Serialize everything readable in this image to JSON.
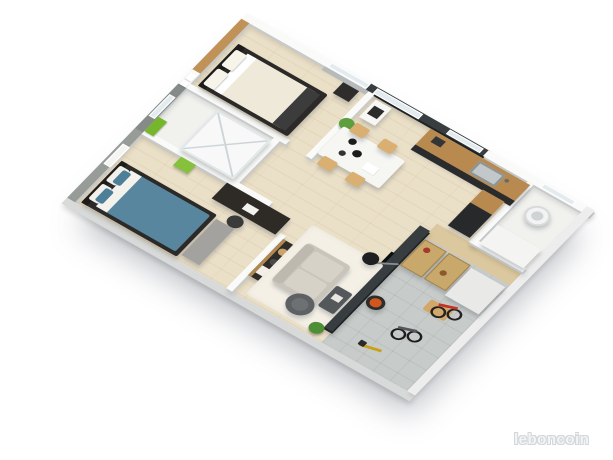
{
  "watermark": {
    "text": "leboncoin",
    "color": "#d3d7da"
  },
  "scene": {
    "type": "3d-isometric-floor-plan",
    "rooms": [
      {
        "name": "bedroom-1",
        "furniture": [
          "double-bed-cream",
          "dark-headboard",
          "dark-throw",
          "nightstand",
          "grey-curtains",
          "wood-accent-wall",
          "wall-frames"
        ]
      },
      {
        "name": "entry",
        "furniture": [
          "hanging-plant",
          "entry-console"
        ]
      },
      {
        "name": "bathroom",
        "furniture": [
          "walk-in-shower",
          "green-towel",
          "window"
        ]
      },
      {
        "name": "bedroom-2",
        "furniture": [
          "double-bed-blue",
          "desk",
          "office-chair",
          "grey-bench",
          "green-cabinet",
          "wall-frame"
        ]
      },
      {
        "name": "living-room",
        "furniture": [
          "light-grey-sofa",
          "white-rug",
          "coffee-table",
          "arc-floor-lamp",
          "dark-armchair",
          "floor-plant",
          "tv-divider-wall",
          "sideboard"
        ]
      },
      {
        "name": "dining-area",
        "furniture": [
          "white-dining-table",
          "wooden-chair",
          "wooden-chair",
          "wooden-chair",
          "wooden-chair",
          "black-tableware"
        ]
      },
      {
        "name": "kitchen",
        "furniture": [
          "l-shaped-counter",
          "steel-sink",
          "dark-cabinets",
          "window",
          "french-doors"
        ]
      },
      {
        "name": "laundry-wc",
        "furniture": [
          "washing-machine",
          "white-cabinet",
          "window"
        ]
      },
      {
        "name": "terrace",
        "furniture": [
          "wood-decking",
          "wooden-shelf-unit",
          "wooden-shelf-unit",
          "storage-cabinet",
          "barbecue",
          "doormat",
          "exercise-bike-red",
          "exercise-bike-black",
          "rowing-machine"
        ]
      }
    ],
    "palette": {
      "background": "#ffffff",
      "wood_floor": "#eadfc7",
      "terrace_stone": "#c7cbc9",
      "bath_tile": "#f1f1ee",
      "dark_feature_wall": "#383d40",
      "wood_accent_wall": "#c09257",
      "white_wall": "#fafaf8",
      "grey_wall": "#979c98",
      "bed1_duvet": "#efe9da",
      "bed2_duvet": "#58869f",
      "sofa": "#cfcbc1",
      "counter_wood_top": "#b98a4f",
      "counter_dark_base": "#27292b",
      "chair_wood": "#d9b072",
      "green_accent": "#76b62c",
      "bbq_orange": "#d2571e",
      "bike_red": "#c23326"
    }
  }
}
